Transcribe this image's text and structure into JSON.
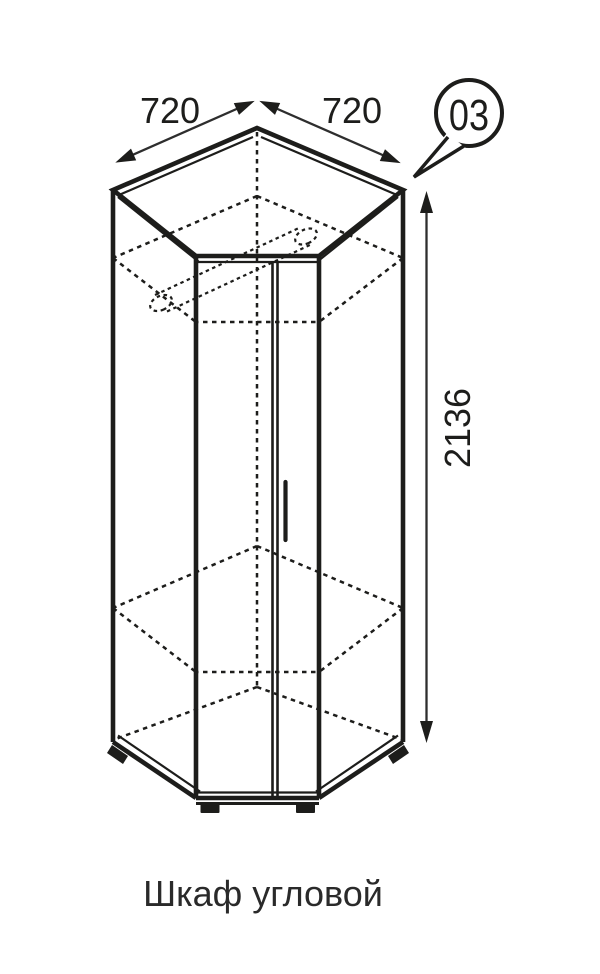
{
  "figure": {
    "callout_number": "03",
    "caption": "Шкаф угловой",
    "dimensions": {
      "width_left": "720",
      "width_right": "720",
      "height": "2136"
    },
    "colors": {
      "ink": "#1d1d1b",
      "dimension_lines": "#2e2e2e",
      "background": "#ffffff"
    }
  }
}
